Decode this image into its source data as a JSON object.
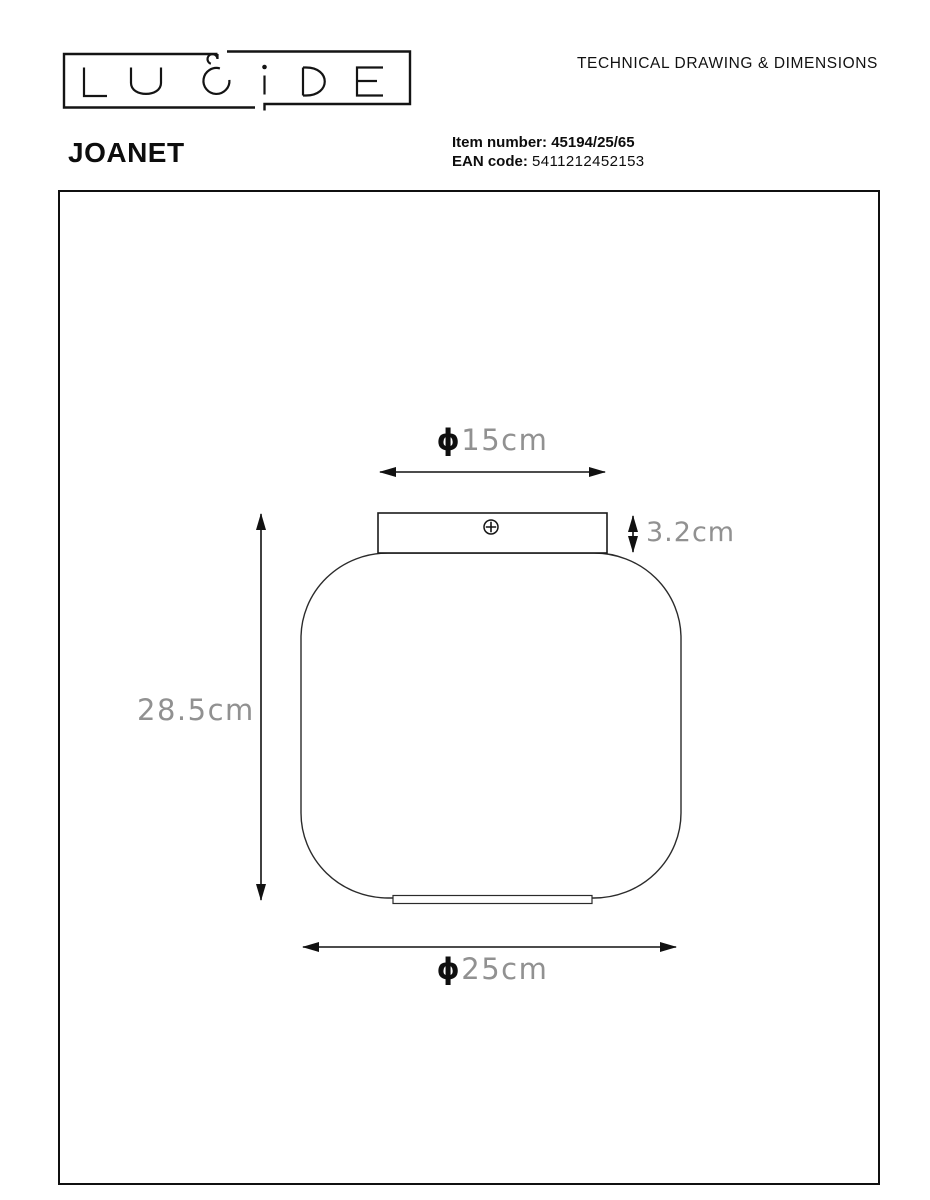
{
  "header": {
    "logo_text": "LUCIDE",
    "doc_title": "TECHNICAL DRAWING & DIMENSIONS",
    "product_name": "JOANET",
    "item_number_label": "Item number:",
    "item_number_value": "45194/25/65",
    "ean_label": "EAN code:",
    "ean_value": "5411212452153"
  },
  "drawing": {
    "type": "technical-drawing",
    "subject": "ceiling lamp front elevation",
    "dims": {
      "top_diameter": {
        "symbol": "ϕ",
        "value": "15cm"
      },
      "plate_height": {
        "value": "3.2cm"
      },
      "total_height": {
        "value": "28.5cm"
      },
      "bottom_diameter": {
        "symbol": "ϕ",
        "value": "25cm"
      }
    },
    "colors": {
      "line": "#1c1c1c",
      "dim_text": "#919191",
      "dim_symbol": "#0f0f0f",
      "frame": "#101010"
    }
  }
}
